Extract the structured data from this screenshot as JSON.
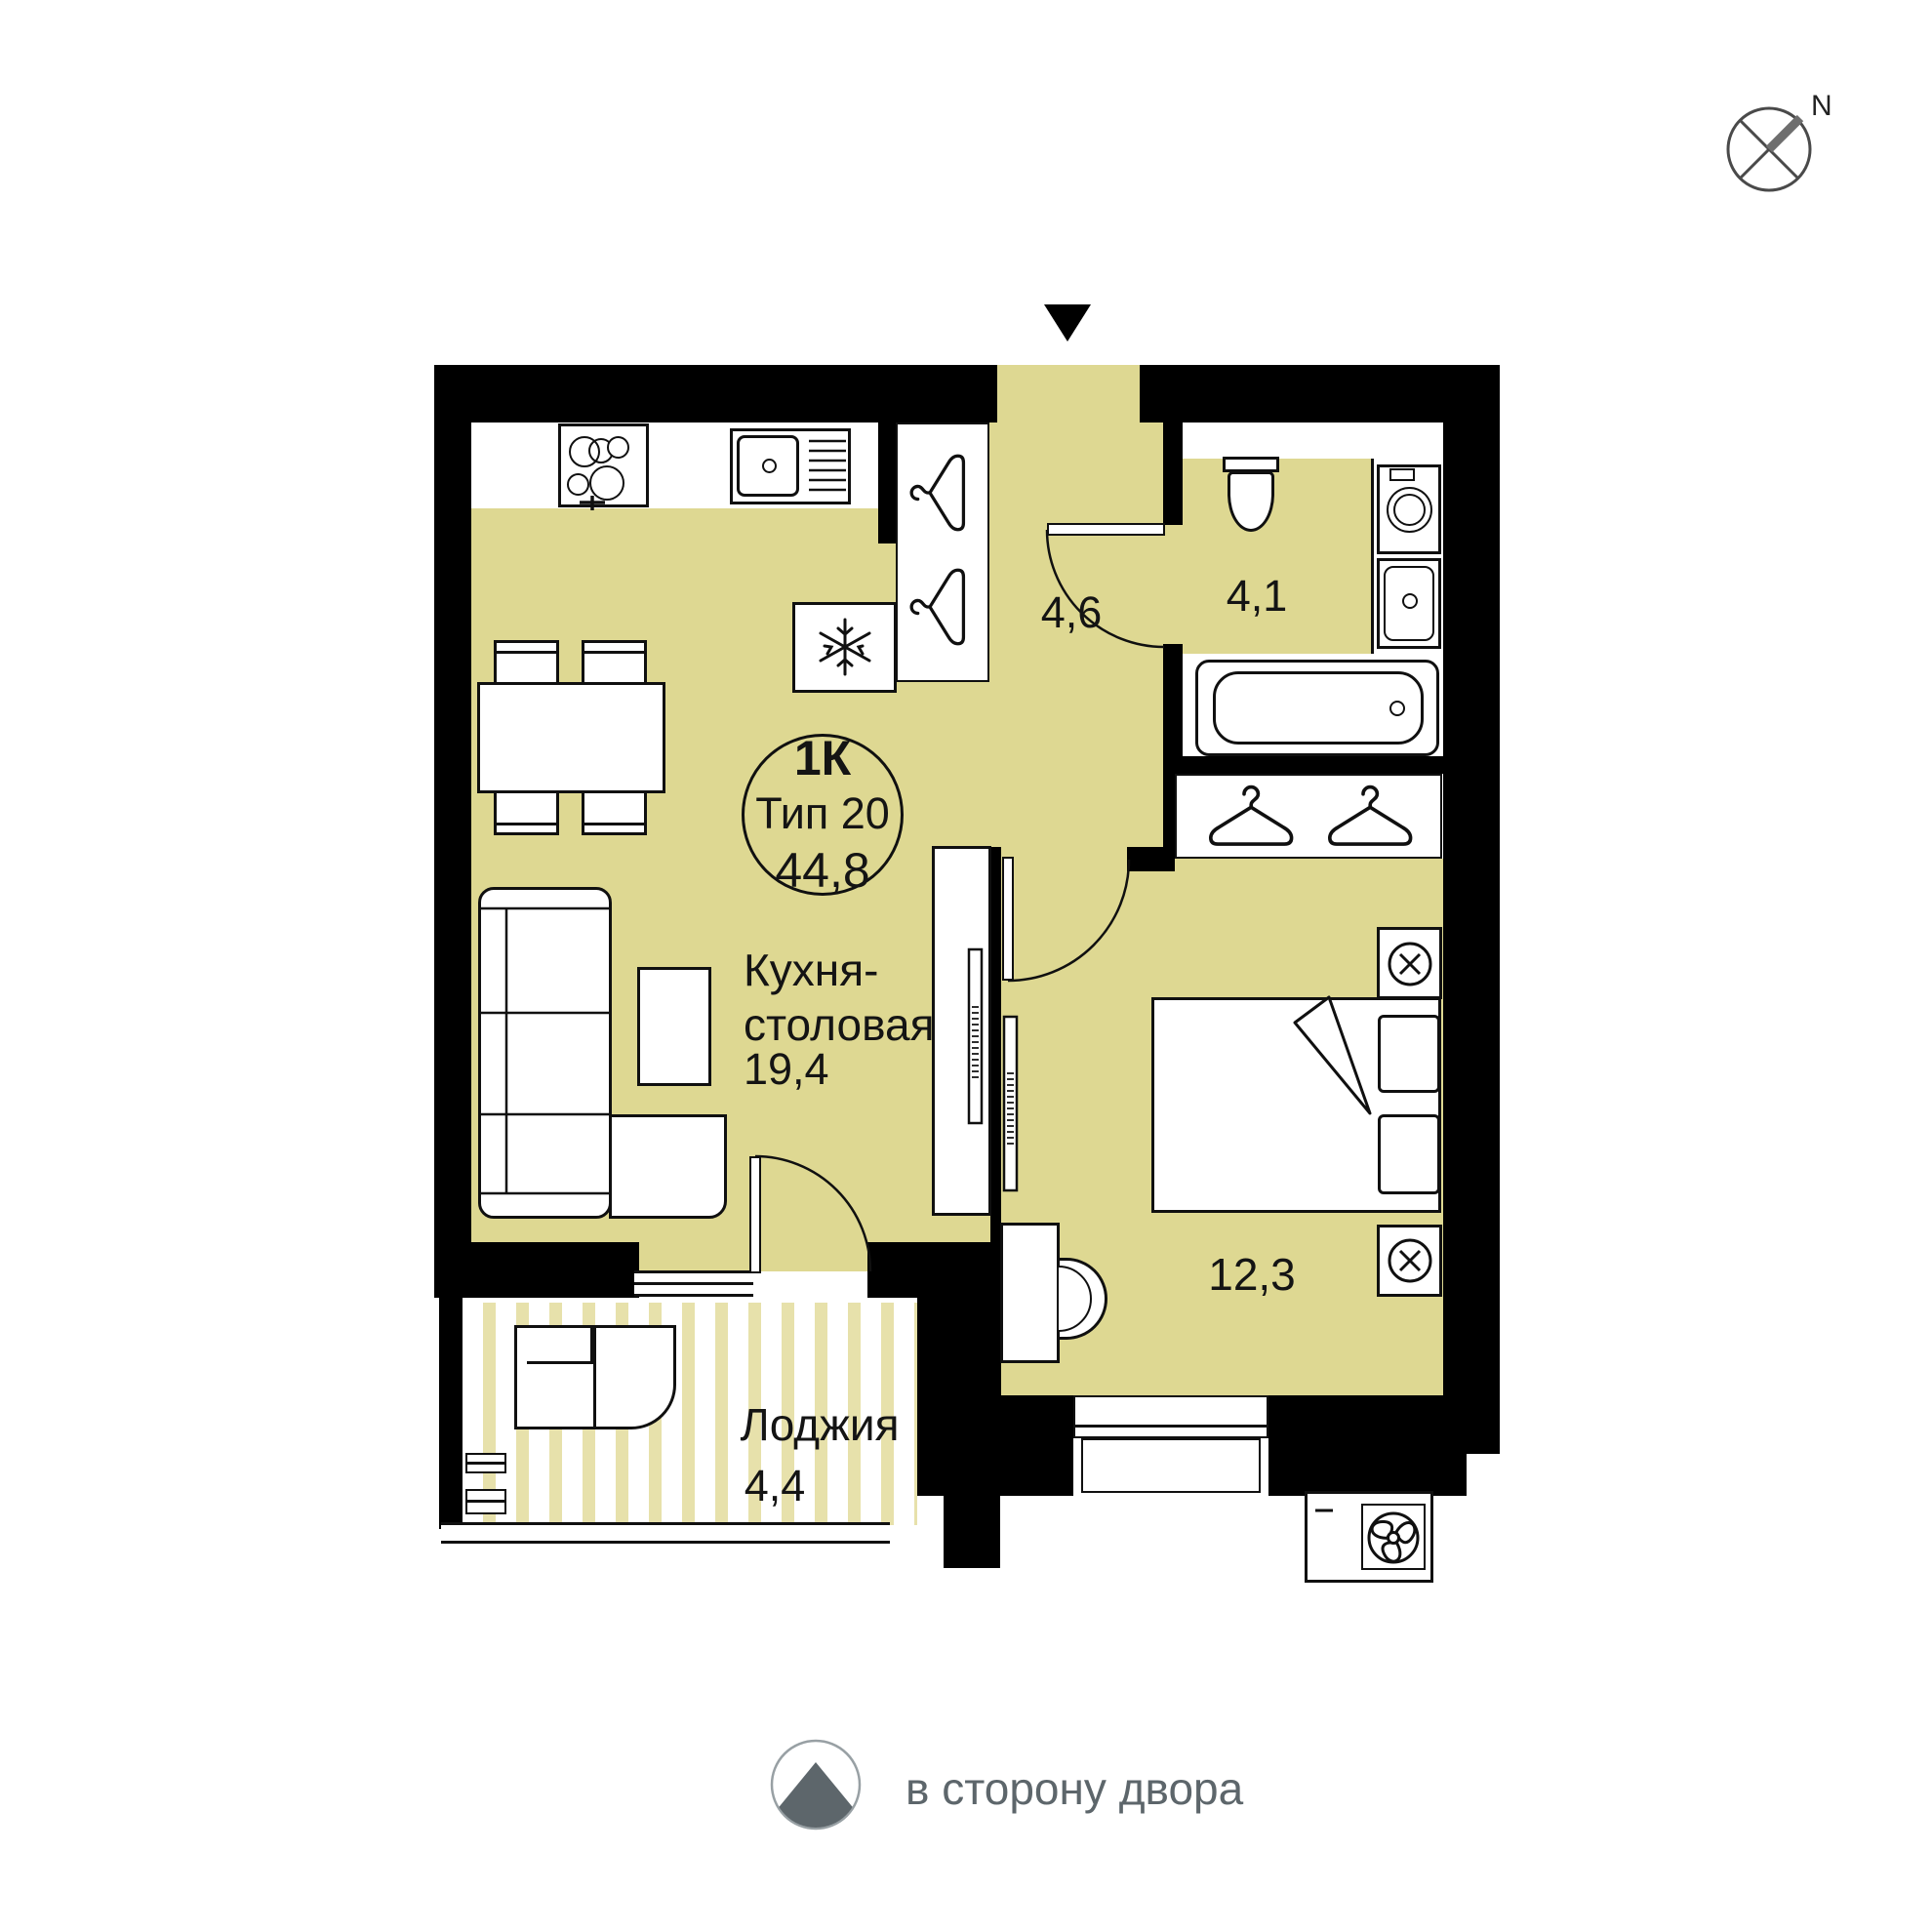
{
  "compass": {
    "label": "N"
  },
  "unit_badge": {
    "rooms": "1К",
    "type": "Тип 20",
    "total_area": "44,8"
  },
  "rooms": {
    "kitchen": {
      "name": "Кухня-столовая",
      "name_line1": "Кухня-",
      "name_line2": "столовая",
      "area": "19,4"
    },
    "hallway": {
      "area": "4,6"
    },
    "bathroom": {
      "area": "4,1"
    },
    "bedroom": {
      "area": "12,3"
    },
    "loggia": {
      "name": "Лоджия",
      "area": "4,4"
    }
  },
  "legend": {
    "courtyard_text": "в сторону двора"
  },
  "icons": [
    "north-compass-icon",
    "entrance-arrow-icon",
    "hanger-icon",
    "snowflake-icon",
    "fan-icon",
    "lamp-icon",
    "courtyard-arrow-icon"
  ],
  "colors": {
    "floor": "#ded892",
    "stripe": "#e7e1ab",
    "wall": "#000000",
    "gray": "#5d666b"
  }
}
